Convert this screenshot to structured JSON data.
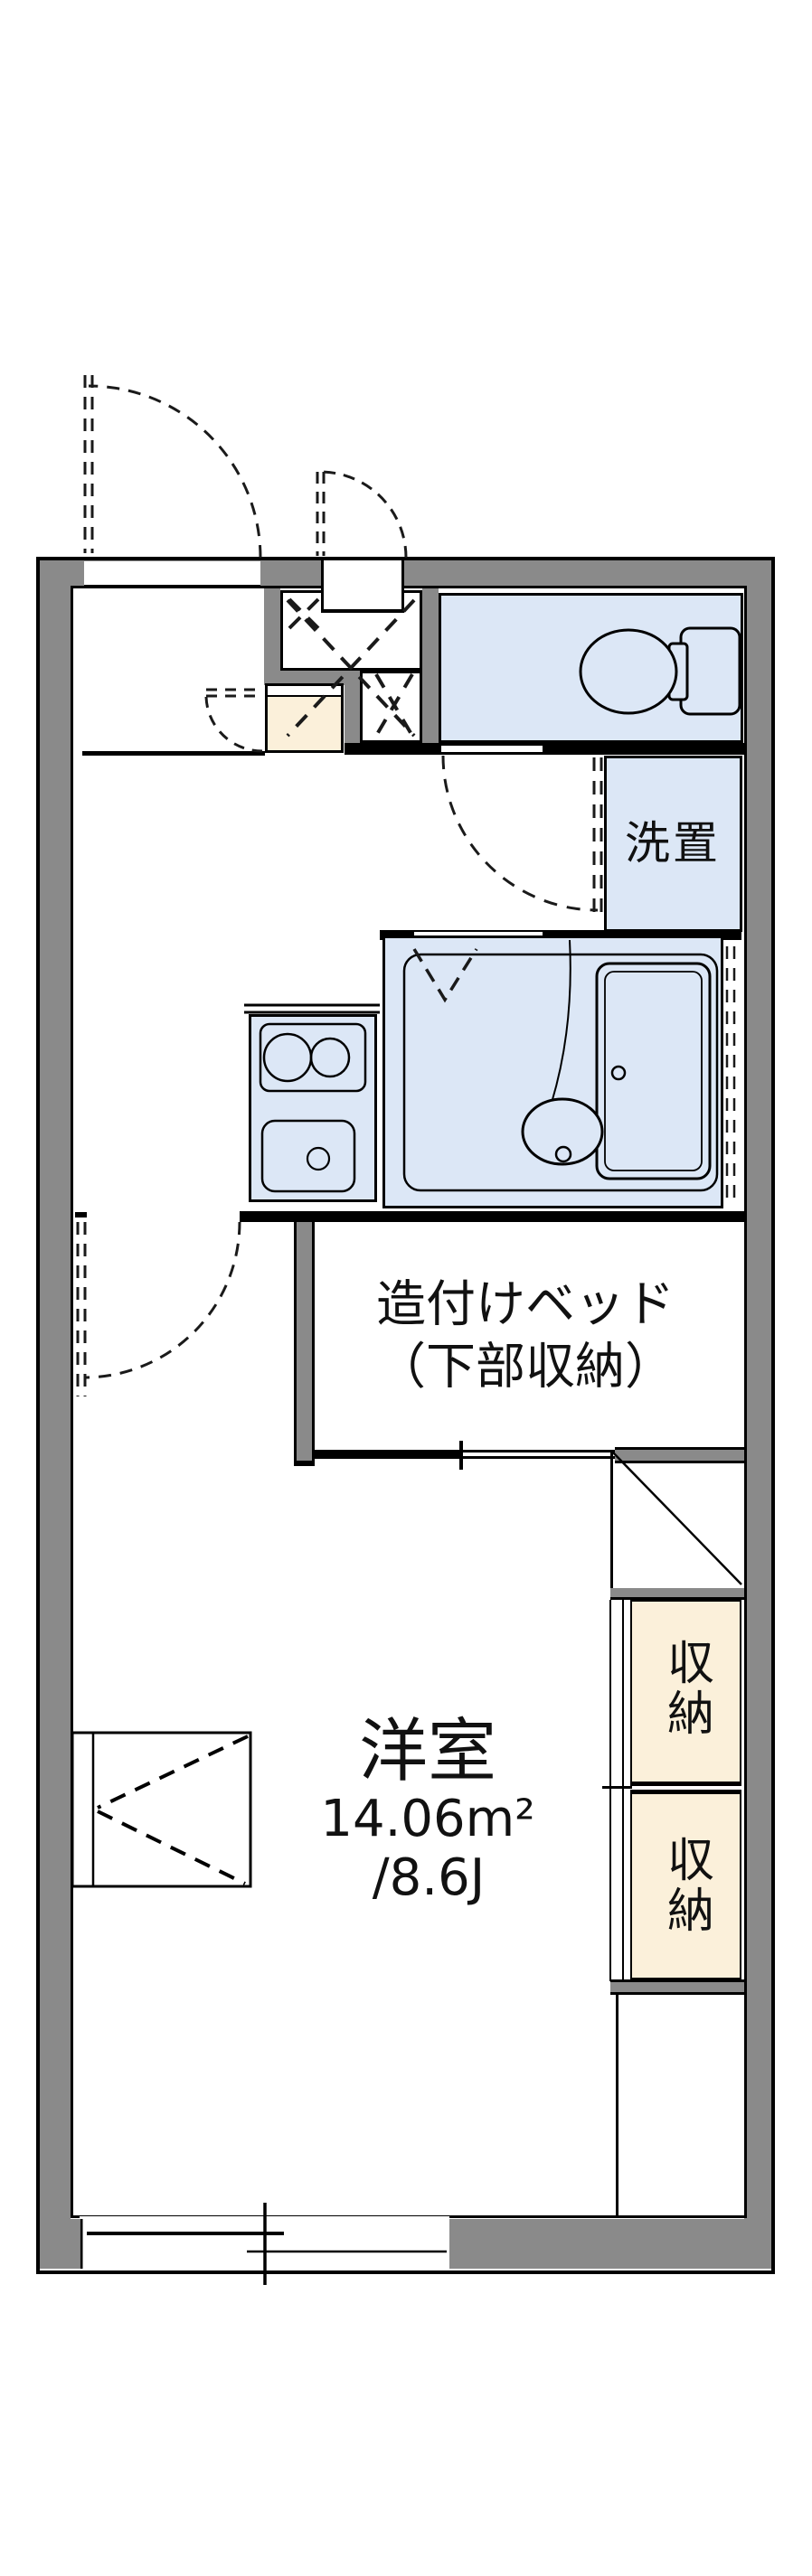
{
  "title": "apartment floor plan",
  "labels": {
    "laundry": "洗置",
    "bed_line1": "造付けベッド",
    "bed_line2": "（下部収納）",
    "room_name": "洋室",
    "room_area_m2": "14.06m²",
    "room_area_jo": "/8.6J",
    "storage_upper": "収納",
    "storage_lower": "収納"
  },
  "colors": {
    "wall_gray": "#8a8a8a",
    "water_blue": "#dce7f6",
    "cabinet_cream": "#fbf0da",
    "line_black": "#000000",
    "background": "#ffffff"
  }
}
